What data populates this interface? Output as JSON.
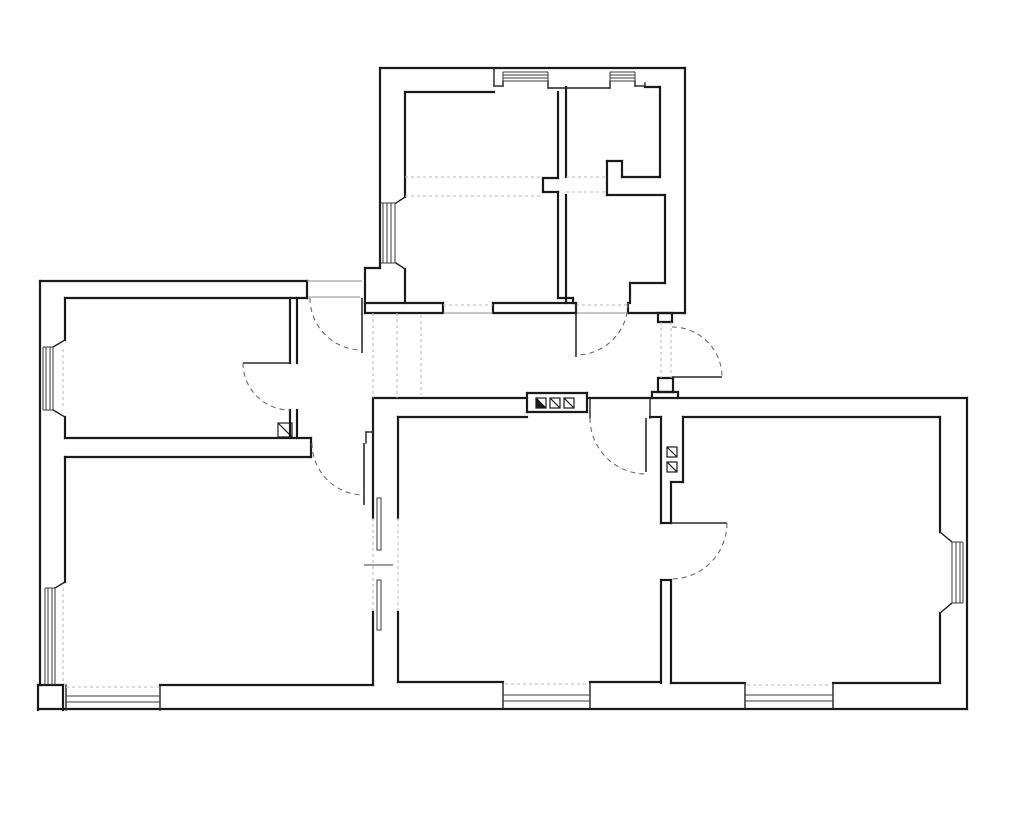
{
  "meta": {
    "type": "architectural-floor-plan",
    "canvas": {
      "width": 1024,
      "height": 820
    },
    "background": "#ffffff",
    "colors": {
      "wall": "#1a1a1a",
      "medium": "#222222",
      "thin": "#3a3a3a",
      "gray": "#8f8f8f",
      "door": "#2a2a2a",
      "arc": "#6b6b6b",
      "light_dash": "#b8b8b8"
    }
  },
  "plan": {
    "wall_segments": [
      [
        380,
        68,
        685,
        68
      ],
      [
        685,
        68,
        685,
        313
      ],
      [
        380,
        68,
        380,
        268
      ],
      [
        365,
        268,
        380,
        268
      ],
      [
        365,
        268,
        365,
        313
      ],
      [
        365,
        313,
        443,
        313
      ],
      [
        493,
        313,
        576,
        313
      ],
      [
        628,
        313,
        685,
        313
      ],
      [
        405,
        92,
        494,
        92
      ],
      [
        405,
        92,
        405,
        197
      ],
      [
        405,
        269,
        405,
        303
      ],
      [
        365,
        303,
        443,
        303
      ],
      [
        493,
        303,
        576,
        303
      ],
      [
        443,
        303,
        443,
        313
      ],
      [
        493,
        303,
        493,
        313
      ],
      [
        576,
        303,
        576,
        313
      ],
      [
        628,
        303,
        628,
        313
      ],
      [
        558,
        298,
        573,
        298
      ],
      [
        573,
        298,
        573,
        303
      ],
      [
        558,
        92,
        558,
        178
      ],
      [
        566,
        87,
        566,
        177
      ],
      [
        543,
        178,
        558,
        178
      ],
      [
        543,
        178,
        543,
        192
      ],
      [
        543,
        192,
        558,
        192
      ],
      [
        558,
        192,
        558,
        298
      ],
      [
        566,
        195,
        566,
        303
      ],
      [
        645,
        87,
        660,
        87
      ],
      [
        660,
        87,
        660,
        177
      ],
      [
        607,
        161,
        622,
        161
      ],
      [
        607,
        161,
        607,
        195
      ],
      [
        622,
        161,
        622,
        177
      ],
      [
        622,
        177,
        660,
        177
      ],
      [
        607,
        195,
        665,
        195
      ],
      [
        665,
        195,
        665,
        283
      ],
      [
        630,
        283,
        665,
        283
      ],
      [
        630,
        283,
        630,
        303
      ],
      [
        40,
        281,
        307,
        281
      ],
      [
        40,
        281,
        40,
        685
      ],
      [
        65,
        298,
        307,
        298
      ],
      [
        307,
        281,
        307,
        298
      ],
      [
        65,
        298,
        65,
        340
      ],
      [
        65,
        417,
        65,
        438
      ],
      [
        65,
        457,
        65,
        582
      ],
      [
        290,
        298,
        290,
        363
      ],
      [
        297,
        298,
        297,
        363
      ],
      [
        290,
        410,
        290,
        438
      ],
      [
        297,
        410,
        297,
        438
      ],
      [
        65,
        438,
        311,
        438
      ],
      [
        65,
        457,
        311,
        457
      ],
      [
        311,
        438,
        311,
        457
      ],
      [
        38,
        685,
        63,
        685
      ],
      [
        38,
        685,
        38,
        710
      ],
      [
        63,
        685,
        63,
        710
      ],
      [
        38,
        709,
        967,
        709
      ],
      [
        160,
        685,
        373,
        685
      ],
      [
        373,
        398,
        373,
        518
      ],
      [
        398,
        417,
        398,
        518
      ],
      [
        373,
        612,
        373,
        685
      ],
      [
        398,
        612,
        398,
        682
      ],
      [
        373,
        398,
        527,
        398
      ],
      [
        587,
        398,
        967,
        398
      ],
      [
        398,
        417,
        527,
        417
      ],
      [
        650,
        417,
        661,
        417
      ],
      [
        661,
        417,
        661,
        523
      ],
      [
        661,
        580,
        661,
        683
      ],
      [
        683,
        417,
        683,
        482
      ],
      [
        671,
        482,
        683,
        482
      ],
      [
        671,
        482,
        671,
        523
      ],
      [
        671,
        580,
        671,
        683
      ],
      [
        661,
        523,
        671,
        523
      ],
      [
        661,
        580,
        671,
        580
      ],
      [
        398,
        682,
        503,
        682
      ],
      [
        590,
        682,
        661,
        682
      ],
      [
        967,
        398,
        967,
        709
      ],
      [
        940,
        417,
        940,
        532
      ],
      [
        940,
        613,
        940,
        683
      ],
      [
        683,
        417,
        940,
        417
      ],
      [
        671,
        683,
        745,
        683
      ],
      [
        833,
        683,
        940,
        683
      ],
      [
        527,
        393,
        587,
        393
      ],
      [
        527,
        393,
        527,
        412
      ],
      [
        587,
        393,
        587,
        412
      ],
      [
        527,
        412,
        587,
        412
      ],
      [
        658,
        313,
        672,
        313
      ],
      [
        658,
        313,
        658,
        322
      ],
      [
        672,
        313,
        672,
        322
      ],
      [
        658,
        322,
        672,
        322
      ],
      [
        658,
        378,
        673,
        378
      ],
      [
        658,
        378,
        658,
        392
      ],
      [
        673,
        378,
        673,
        392
      ],
      [
        658,
        392,
        673,
        392
      ],
      [
        652,
        392,
        652,
        398
      ],
      [
        678,
        392,
        678,
        398
      ],
      [
        652,
        392,
        678,
        392
      ]
    ],
    "medium_segments": [
      [
        590,
        398,
        590,
        418
      ],
      [
        650,
        398,
        650,
        418
      ],
      [
        396,
        203,
        405,
        197
      ],
      [
        396,
        263,
        405,
        269
      ],
      [
        53,
        347,
        65,
        340
      ],
      [
        53,
        410,
        65,
        417
      ],
      [
        55,
        588,
        65,
        582
      ],
      [
        940,
        532,
        952,
        542
      ],
      [
        940,
        613,
        952,
        603
      ],
      [
        494,
        68,
        494,
        86
      ],
      [
        494,
        86,
        503,
        86
      ],
      [
        503,
        81,
        503,
        86
      ],
      [
        548,
        81,
        548,
        88
      ],
      [
        548,
        88,
        610,
        88
      ],
      [
        610,
        81,
        610,
        88
      ],
      [
        635,
        81,
        635,
        86
      ],
      [
        635,
        86,
        645,
        86
      ],
      [
        645,
        83,
        645,
        87
      ],
      [
        66,
        685,
        66,
        710
      ],
      [
        160,
        685,
        160,
        710
      ],
      [
        503,
        682,
        503,
        709
      ],
      [
        590,
        682,
        590,
        709
      ],
      [
        745,
        683,
        745,
        709
      ],
      [
        833,
        683,
        833,
        709
      ],
      [
        366,
        432,
        373,
        432
      ],
      [
        366,
        432,
        366,
        443
      ]
    ],
    "window_line_segments": [
      [
        383,
        203,
        383,
        263
      ],
      [
        387,
        203,
        387,
        263
      ],
      [
        391,
        203,
        391,
        263
      ],
      [
        395,
        203,
        395,
        263
      ],
      [
        381,
        203,
        396,
        203
      ],
      [
        381,
        263,
        396,
        263
      ],
      [
        43,
        347,
        43,
        410
      ],
      [
        46,
        347,
        46,
        410
      ],
      [
        50,
        347,
        50,
        410
      ],
      [
        53,
        347,
        53,
        410
      ],
      [
        43,
        347,
        53,
        347
      ],
      [
        43,
        410,
        53,
        410
      ],
      [
        45,
        588,
        45,
        685
      ],
      [
        48,
        588,
        48,
        685
      ],
      [
        52,
        588,
        52,
        685
      ],
      [
        55,
        588,
        55,
        685
      ],
      [
        45,
        588,
        55,
        588
      ],
      [
        503,
        72,
        548,
        72
      ],
      [
        503,
        75,
        548,
        75
      ],
      [
        503,
        78,
        548,
        78
      ],
      [
        503,
        81,
        548,
        81
      ],
      [
        503,
        72,
        503,
        81
      ],
      [
        548,
        72,
        548,
        81
      ],
      [
        610,
        72,
        635,
        72
      ],
      [
        610,
        75,
        635,
        75
      ],
      [
        610,
        78,
        635,
        78
      ],
      [
        610,
        81,
        635,
        81
      ],
      [
        610,
        72,
        610,
        81
      ],
      [
        635,
        72,
        635,
        81
      ],
      [
        952,
        542,
        952,
        603
      ],
      [
        956,
        542,
        956,
        603
      ],
      [
        960,
        542,
        960,
        603
      ],
      [
        963,
        542,
        963,
        603
      ],
      [
        952,
        542,
        963,
        542
      ],
      [
        952,
        603,
        963,
        603
      ],
      [
        66,
        696,
        160,
        696
      ],
      [
        66,
        702,
        160,
        702
      ],
      [
        503,
        695,
        590,
        695
      ],
      [
        503,
        701,
        590,
        701
      ],
      [
        745,
        695,
        833,
        695
      ],
      [
        745,
        701,
        833,
        701
      ],
      [
        364,
        565,
        393,
        565
      ]
    ],
    "gray_segments": [
      [
        443,
        313,
        493,
        313
      ],
      [
        576,
        313,
        628,
        313
      ],
      [
        307,
        281,
        362,
        281
      ],
      [
        308,
        297,
        360,
        297
      ]
    ],
    "light_dashed_segments": [
      [
        405,
        177,
        543,
        177
      ],
      [
        405,
        196,
        543,
        196
      ],
      [
        566,
        177,
        607,
        177
      ],
      [
        566,
        192,
        607,
        192
      ],
      [
        373,
        313,
        373,
        398
      ],
      [
        397,
        313,
        397,
        398
      ],
      [
        421,
        315,
        421,
        395
      ],
      [
        661,
        322,
        661,
        378
      ],
      [
        671,
        322,
        671,
        378
      ],
      [
        373,
        518,
        373,
        612
      ],
      [
        398,
        518,
        398,
        612
      ],
      [
        63,
        349,
        63,
        408
      ],
      [
        63,
        588,
        63,
        683
      ],
      [
        66,
        687,
        160,
        687
      ],
      [
        505,
        684,
        588,
        684
      ],
      [
        747,
        685,
        831,
        685
      ],
      [
        443,
        305,
        493,
        305
      ],
      [
        576,
        305,
        628,
        305
      ]
    ],
    "window_slots": [
      {
        "x": 377,
        "y": 498,
        "w": 4,
        "h": 52
      },
      {
        "x": 377,
        "y": 580,
        "w": 4,
        "h": 50
      }
    ],
    "door_leaves": [
      [
        362,
        298,
        362,
        353
      ],
      [
        243,
        363,
        290,
        363
      ],
      [
        364,
        443,
        364,
        505
      ],
      [
        576,
        303,
        576,
        357
      ],
      [
        672,
        377,
        722,
        377
      ],
      [
        646,
        418,
        646,
        472
      ],
      [
        671,
        523,
        727,
        523
      ]
    ],
    "door_arcs": [
      {
        "cx": 362,
        "cy": 298,
        "r": 52,
        "start": 180,
        "end": 90,
        "sweep": 0
      },
      {
        "cx": 290,
        "cy": 363,
        "r": 47,
        "start": 180,
        "end": 90,
        "sweep": 0
      },
      {
        "cx": 364,
        "cy": 443,
        "r": 52,
        "start": 180,
        "end": 90,
        "sweep": 0
      },
      {
        "cx": 576,
        "cy": 303,
        "r": 52,
        "start": 0,
        "end": 90,
        "sweep": 1
      },
      {
        "cx": 672,
        "cy": 377,
        "r": 50,
        "start": 270,
        "end": 360,
        "sweep": 1
      },
      {
        "cx": 646,
        "cy": 418,
        "r": 56,
        "start": 180,
        "end": 90,
        "sweep": 0
      },
      {
        "cx": 671,
        "cy": 523,
        "r": 56,
        "start": 0,
        "end": 90,
        "sweep": 1
      }
    ],
    "flue_symbols": [
      {
        "x": 278,
        "y": 423,
        "s": 14,
        "filled": false
      },
      {
        "x": 536,
        "y": 398,
        "s": 10,
        "filled": true
      },
      {
        "x": 550,
        "y": 398,
        "s": 10,
        "filled": false
      },
      {
        "x": 564,
        "y": 398,
        "s": 10,
        "filled": false
      },
      {
        "x": 667,
        "y": 447,
        "s": 10,
        "filled": false
      },
      {
        "x": 667,
        "y": 462,
        "s": 10,
        "filled": false
      }
    ]
  }
}
